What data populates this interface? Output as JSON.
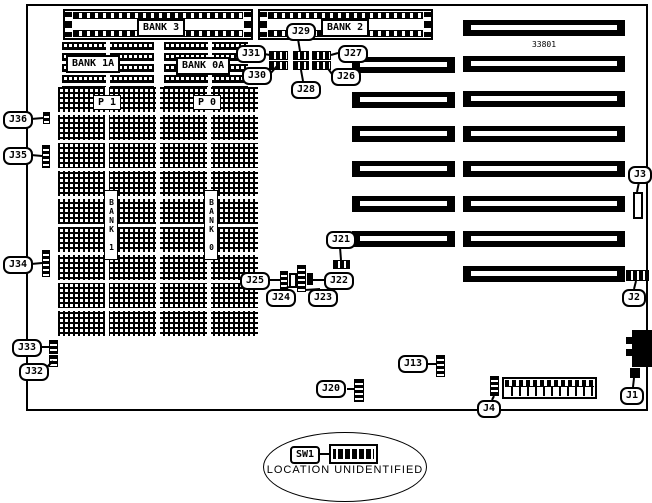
{
  "diagram": {
    "part_number": "33801",
    "note": "LOCATION UNIDENTIFIED",
    "switch_label": "SW1",
    "memory": {
      "bank3": "BANK 3",
      "bank2": "BANK 2",
      "bank1a": "BANK 1A",
      "bank0a": "BANK 0A",
      "p1": "P 1",
      "p0": "P 0",
      "bank1": "BANK 1",
      "bank0": "BANK 0"
    },
    "jumpers": {
      "j1": "J1",
      "j2": "J2",
      "j3": "J3",
      "j4": "J4",
      "j13": "J13",
      "j20": "J20",
      "j21": "J21",
      "j22": "J22",
      "j23": "J23",
      "j24": "J24",
      "j25": "J25",
      "j26": "J26",
      "j27": "J27",
      "j28": "J28",
      "j29": "J29",
      "j30": "J30",
      "j31": "J31",
      "j32": "J32",
      "j33": "J33",
      "j34": "J34",
      "j35": "J35",
      "j36": "J36"
    }
  }
}
